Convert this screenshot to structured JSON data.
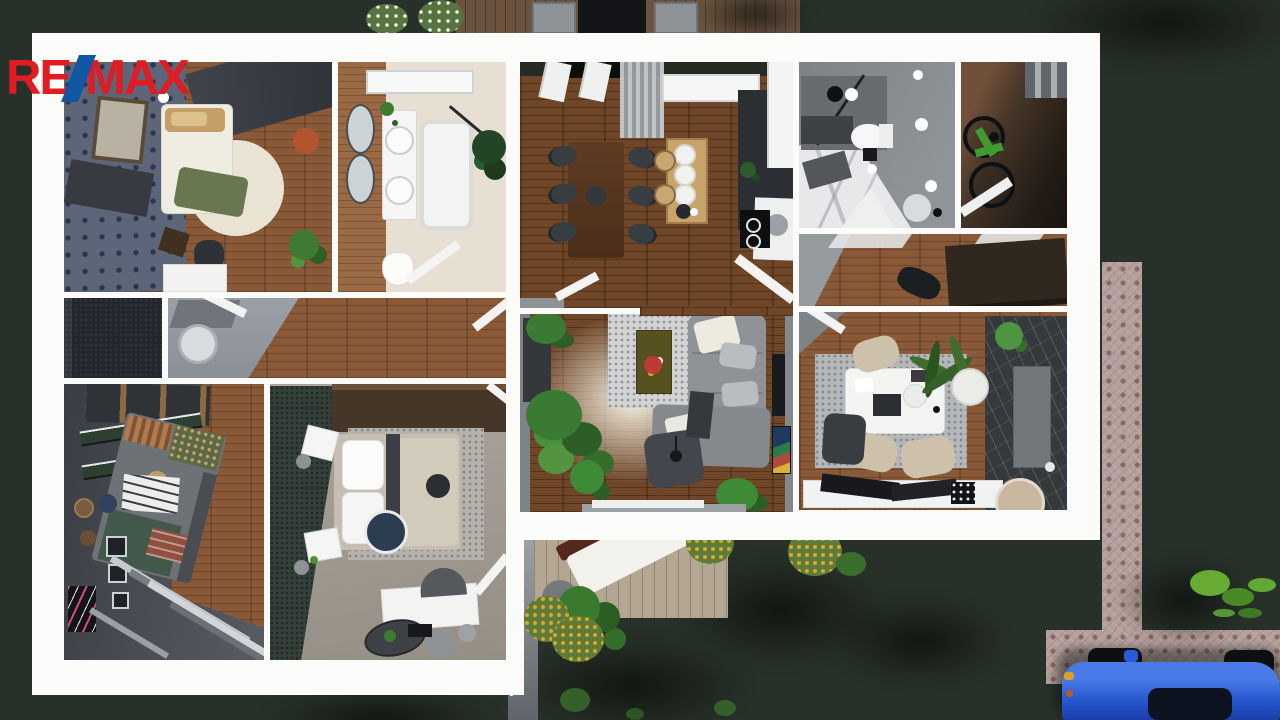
{
  "brand": {
    "name": "RE/MAX",
    "re": "RE",
    "slash": "/",
    "max": "MAX",
    "red": "#e11b22",
    "blue": "#1356a2"
  },
  "scene": {
    "type": "3d-floorplan-top-view-render",
    "background_grass": "#273129",
    "plan_frame": "#fbfbfa"
  },
  "colors": {
    "kitchen_wood": "#6f4628",
    "light_wood": "#8a5a38",
    "paver_path": "#b4a09c",
    "car_blue": "#2453cc",
    "sofa_gray": "#8f9297",
    "rug_gray": "#d2d3d5",
    "wallpaper_blue": "#5d6579",
    "green_wall": "#34403a",
    "dark_marble": "#36393c",
    "white_marble": "#e8e8ea"
  },
  "rooms": [
    {
      "id": "bedroom-1",
      "area": "top-left"
    },
    {
      "id": "bathroom-1",
      "area": "top-mid-left"
    },
    {
      "id": "kitchen-dining",
      "area": "top-center"
    },
    {
      "id": "bathroom-2",
      "area": "top-right"
    },
    {
      "id": "bike-storage",
      "area": "top-far-right"
    },
    {
      "id": "utility-dark-room",
      "area": "mid-left"
    },
    {
      "id": "hallway",
      "area": "mid-left-band"
    },
    {
      "id": "corridor",
      "area": "mid-right"
    },
    {
      "id": "bedroom-2",
      "area": "bottom-left"
    },
    {
      "id": "bedroom-master",
      "area": "bottom-mid-left"
    },
    {
      "id": "living-room",
      "area": "center"
    },
    {
      "id": "office",
      "area": "bottom-right"
    }
  ],
  "outdoor": [
    "lawn",
    "top-terrace-with-dining",
    "garden-deck-with-lounger",
    "paver-walkway",
    "blue-car",
    "shrubs"
  ]
}
